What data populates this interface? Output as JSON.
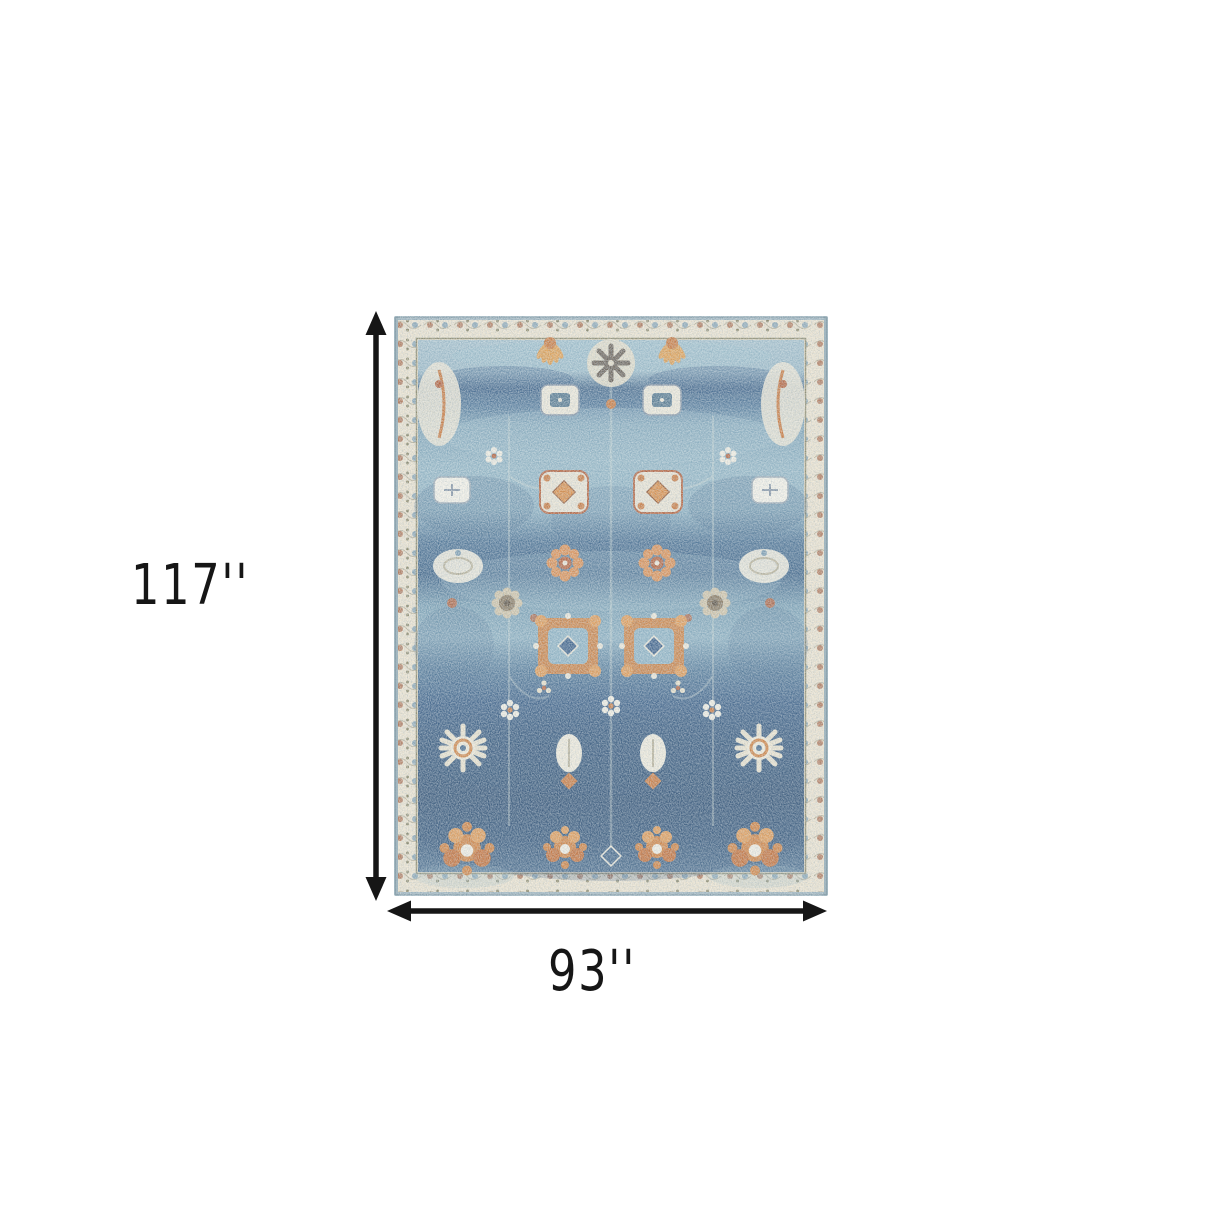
{
  "canvas": {
    "width_px": 1214,
    "height_px": 1214,
    "background": "#ffffff"
  },
  "diagram": {
    "type": "product-dimension-diagram",
    "subject": "blue and orange distressed oriental area rug",
    "height_label": "117''",
    "width_label": "93''",
    "arrow_color": "#161616",
    "label_color": "#161616"
  },
  "rug_palette": {
    "edge_blue": "#9db3bd",
    "border_cream": "#ebe2ce",
    "border_line_olive": "#8e8a6c",
    "field_light_blue": "#a6c1cd",
    "field_mid_blue": "#6d93ad",
    "field_navy": "#3c5c7c",
    "accent_orange": "#d08343",
    "accent_rust": "#b4623d",
    "accent_cream": "#ece7d8",
    "accent_taupe": "#8a7a62"
  }
}
